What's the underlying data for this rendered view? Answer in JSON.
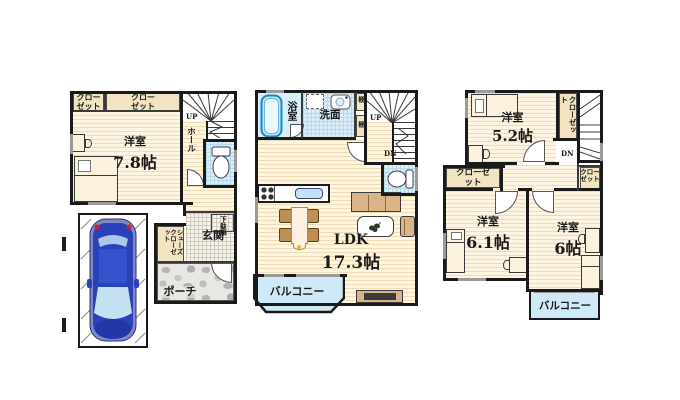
{
  "colors": {
    "wall": "#1a1a1a",
    "floor_base": "#fdf4e2",
    "floor_stripe": "#eedcb6",
    "wet_area_blue": "#d9eefb",
    "closet_beige": "#f2e4c0",
    "balcony_blue": "#cfe9f6",
    "porch_stone_gray": "#b7b6b2",
    "furniture_tan": "#d9b488",
    "car_body_blue": "#2a41b8"
  },
  "f1": {
    "closet_a": "クローゼット",
    "closet_b": "クローゼット",
    "bedroom": {
      "name": "洋室",
      "size": "7.8帖"
    },
    "up": "UP",
    "hall": "ホール",
    "genkan": "玄関",
    "shoe_cabinet": "下駄箱",
    "shoes_closet": "シューズクローゼット",
    "porch": "ポーチ"
  },
  "f2": {
    "bath": "浴室",
    "washroom": "洗面",
    "shelf_a": "棚",
    "shelf_b": "棚",
    "up": "UP",
    "dn": "DN",
    "ldk": {
      "name": "LDK",
      "size": "17.3帖"
    },
    "balcony": "バルコニー"
  },
  "f3": {
    "room_a": {
      "name": "洋室",
      "size": "5.2帖"
    },
    "closet_top": "クローゼット",
    "dn": "DN",
    "closet_left": "クローゼット",
    "closet_right": "クローゼット",
    "room_b": {
      "name": "洋室",
      "size": "6.1帖"
    },
    "room_c": {
      "name": "洋室",
      "size": "6帖"
    },
    "balcony": "バルコニー"
  }
}
